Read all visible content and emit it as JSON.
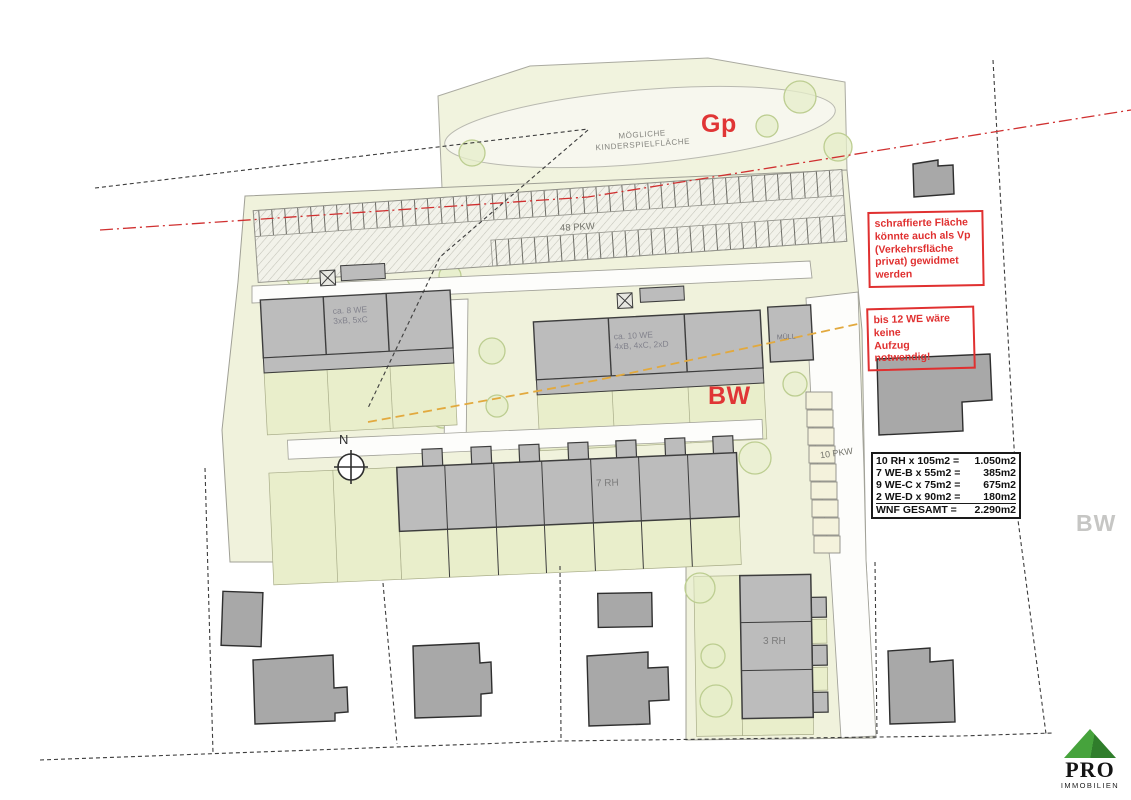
{
  "plan": {
    "playground_label_line1": "MÖGLICHE",
    "playground_label_line2": "KINDERSPIELFLÄCHE",
    "gp_label": "Gp",
    "bw_label": "BW",
    "bw_label_right": "BW",
    "parking_main_label": "48 PKW",
    "parking_side_label": "10 PKW",
    "north_label": "N",
    "buildings": {
      "apt_left_line1": "ca. 8 WE",
      "apt_left_line2": "3xB, 5xC",
      "apt_mid_line1": "ca. 10 WE",
      "apt_mid_line2": "4xB, 4xC, 2xD",
      "muell": "MÜLL",
      "rowhouse_7": "7 RH",
      "rowhouse_3": "3 RH"
    }
  },
  "annotations": {
    "vp_note": {
      "lines": [
        "schraffierte Fläche",
        "könnte auch als Vp",
        "(Verkehrsfläche",
        "privat) gewidmet",
        "werden"
      ]
    },
    "lift_note": {
      "lines": [
        "bis 12 WE wäre",
        "keine",
        "Aufzug notwendig!"
      ]
    }
  },
  "summary": {
    "rows": [
      {
        "label": "10 RH x 105m2 =",
        "value": "1.050m2"
      },
      {
        "label": "7 WE-B x 55m2 =",
        "value": "385m2"
      },
      {
        "label": "9 WE-C x 75m2 =",
        "value": "675m2"
      },
      {
        "label": "2 WE-D x 90m2 =",
        "value": "180m2"
      },
      {
        "label": "WNF GESAMT =",
        "value": "2.290m2"
      }
    ]
  },
  "logo": {
    "name": "PRO",
    "subtitle": "IMMOBILIEN"
  },
  "colors": {
    "site_green": "#f0f2dc",
    "garden_green": "#e9eecb",
    "new_building_gray": "#bcbcbc",
    "existing_building_gray": "#a8a8a8",
    "accent_red": "#e03535",
    "orange_line": "#e2a93e",
    "logo_green": "#3f9c3a"
  }
}
